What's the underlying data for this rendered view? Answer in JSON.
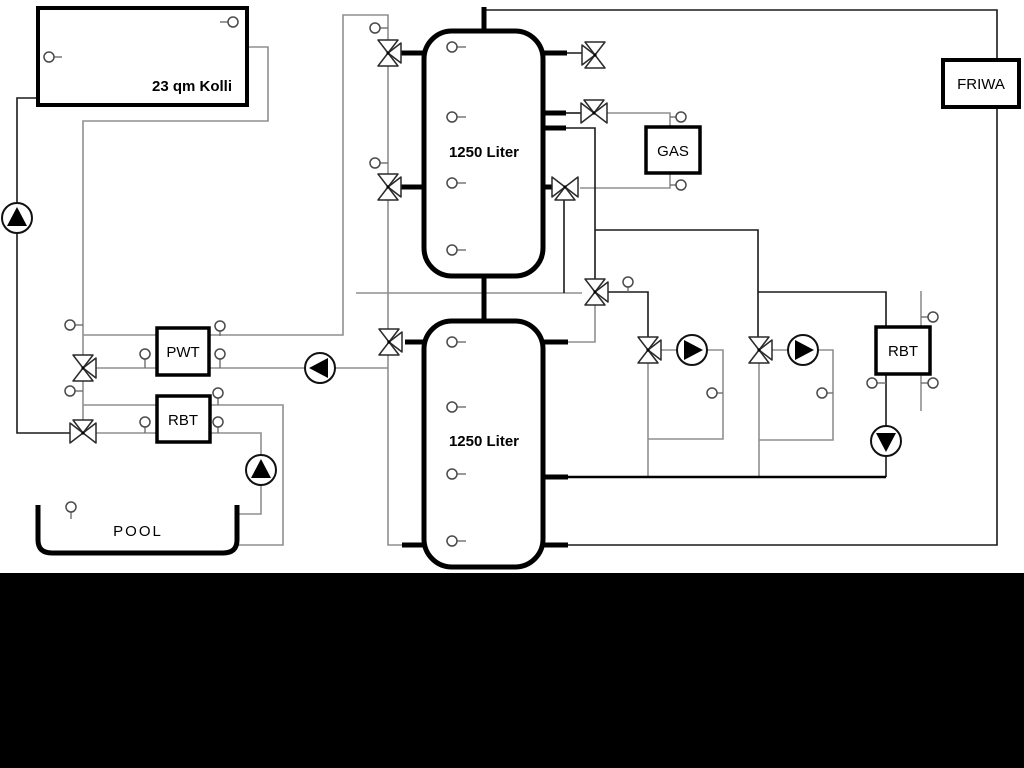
{
  "diagram": {
    "background_color": "#ffffff",
    "letterbox_color": "#000000",
    "pipe_gray_color": "#8f8f8f",
    "pipe_black_color": "#1a1a1a",
    "labels": {
      "collector": "23 qm Kolli",
      "tank_top": "1250 Liter",
      "tank_bottom": "1250 Liter",
      "pwt": "PWT",
      "rbt_left": "RBT",
      "gas": "GAS",
      "friwa": "FRIWA",
      "rbt_right": "RBT",
      "pool": "POOL"
    },
    "components": {
      "pumps": 6,
      "three_way_valves": 11,
      "sensors": 29
    }
  }
}
